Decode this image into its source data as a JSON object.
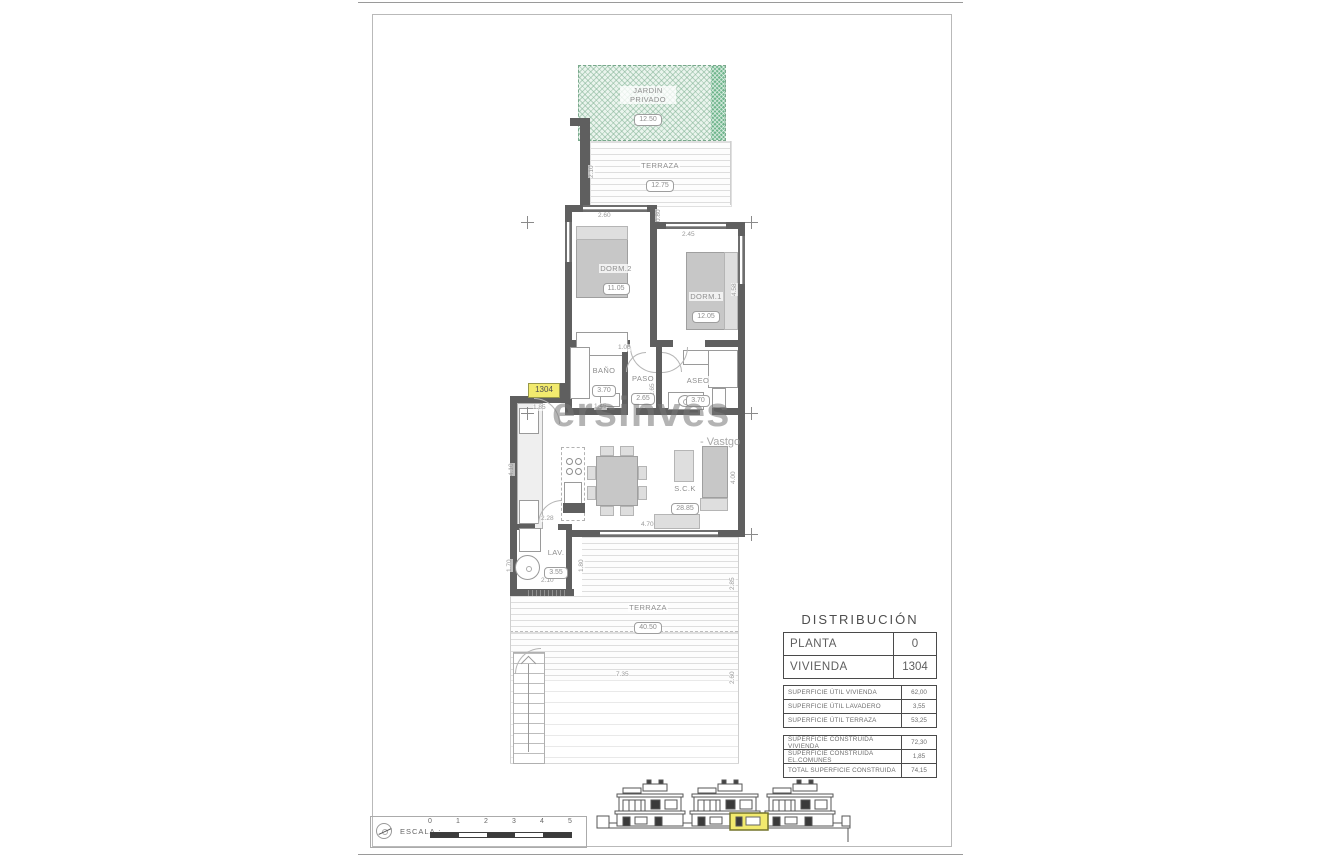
{
  "sheet": {
    "watermark_main": "ersinves",
    "watermark_sub": "- Vastgo"
  },
  "plan": {
    "unit_tag": "1304",
    "rooms": [
      {
        "name": "JARDÍN PRIVADO",
        "value": "12.50"
      },
      {
        "name": "TERRAZA",
        "value": "12.75"
      },
      {
        "name": "DORM.2",
        "value": "11.05"
      },
      {
        "name": "DORM.1",
        "value": "12.05"
      },
      {
        "name": "BAÑO",
        "value": "3.70"
      },
      {
        "name": "PASO",
        "value": "2.65"
      },
      {
        "name": "ASEO",
        "value": "3.70"
      },
      {
        "name": "S.C.K",
        "value": "28.85"
      },
      {
        "name": "LAV.",
        "value": "3.55"
      },
      {
        "name": "TERRAZA",
        "value": "40.50"
      }
    ],
    "dims": [
      "2.10",
      "2.60",
      "2.45",
      "0.80",
      "4.58",
      "1.00",
      "1.45",
      "2.65",
      "1.85",
      "4.10",
      "2.28",
      "2.10",
      "1.70",
      "1.80",
      "4.70",
      "4.00",
      "2.85",
      "7.35",
      "2.60"
    ]
  },
  "panel": {
    "title": "DISTRIBUCIÓN",
    "info_rows": [
      {
        "label": "PLANTA",
        "value": "0"
      },
      {
        "label": "VIVIENDA",
        "value": "1304"
      }
    ],
    "util_rows": [
      {
        "label": "SUPERFICIE ÚTIL VIVIENDA",
        "value": "62,00"
      },
      {
        "label": "SUPERFICIE ÚTIL LAVADERO",
        "value": "3,55"
      },
      {
        "label": "SUPERFICIE ÚTIL TERRAZA",
        "value": "53,25"
      }
    ],
    "built_rows": [
      {
        "label": "SUPERFICIE CONSTRUIDA VIVIENDA",
        "value": "72,30"
      },
      {
        "label": "SUPERFICIE CONSTRUIDA EL.COMUNES",
        "value": "1,85"
      },
      {
        "label": "TOTAL SUPERFICIE CONSTRUIDA",
        "value": "74,15"
      }
    ]
  },
  "scalebar": {
    "label": "ESCALA :",
    "ticks": [
      "0",
      "1",
      "2",
      "3",
      "4",
      "5"
    ]
  },
  "colors": {
    "accent_yellow": "#f2ea6e",
    "garden_green": "#6fb58c",
    "wall_gray": "#5f5f5f"
  }
}
